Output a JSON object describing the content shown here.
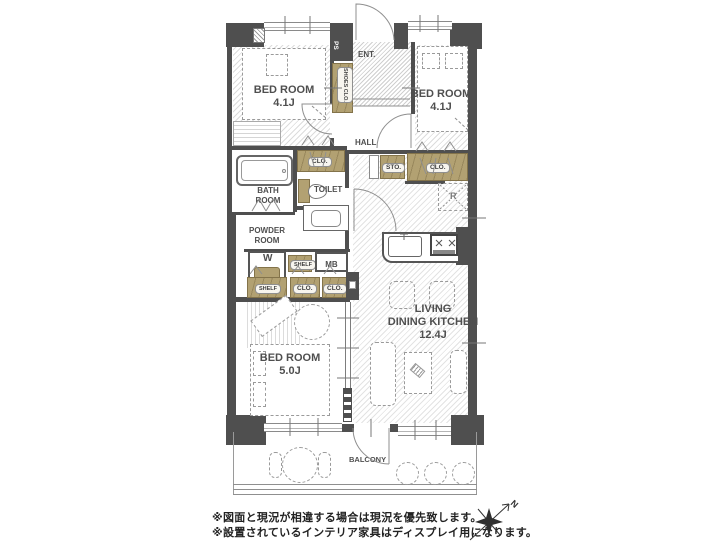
{
  "labels": {
    "bedroom": "BED ROOM",
    "size_41a": "4.1J",
    "size_41b": "4.1J",
    "size_50": "5.0J",
    "living": "LIVING",
    "dining_kitchen": "DINING KITCHEN",
    "size_ldk": "12.4J",
    "ent": "ENT.",
    "hall": "HALL",
    "shoes_clo": "SHOES CLO.",
    "ps": "PS",
    "clo": "CLO.",
    "sto": "STO.",
    "shelf": "SHELF",
    "mb": "MB",
    "toilet": "TOILET",
    "bath_line1": "BATH",
    "bath_line2": "ROOM",
    "powder_line1": "POWDER",
    "powder_line2": "ROOM",
    "washer": "W",
    "fridge": "R",
    "balcony": "BALCONY",
    "compass_north": "N"
  },
  "notes": {
    "line1": "※図面と現況が相違する場合は現況を優先致します。",
    "line2": "※設置されているインテリア家具はディスプレイ用になります。"
  },
  "colors": {
    "wall": "#4f4f4f",
    "closet_fill": "#b2a172",
    "closet_border": "#83734a",
    "hatch": "#dcdcdc",
    "linework": "#8a8a8a",
    "text": "#4a4a4a"
  }
}
